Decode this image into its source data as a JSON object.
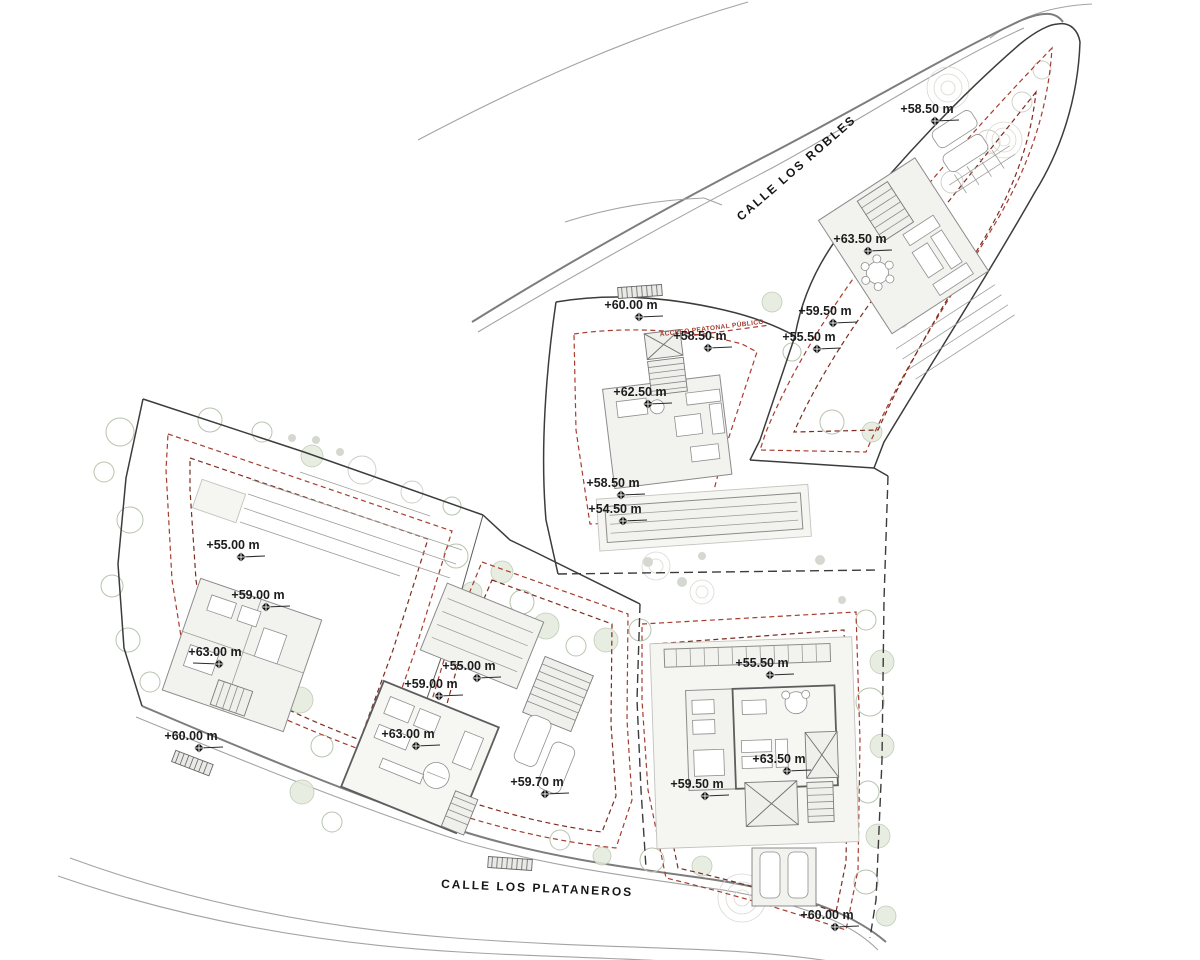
{
  "document": {
    "type": "architectural-site-plan"
  },
  "streets": [
    {
      "id": "robles",
      "name": "CALLE LOS ROBLES"
    },
    {
      "id": "plataneros",
      "name": "CALLE LOS PLATANEROS"
    }
  ],
  "annotations": {
    "public_path": "ACCESO PEATONAL PÚBLICO"
  },
  "elevation_markers": [
    {
      "label": "+58.50 m",
      "x": 935,
      "y": 121,
      "dir": "right"
    },
    {
      "label": "+63.50 m",
      "x": 868,
      "y": 251,
      "dir": "right"
    },
    {
      "label": "+59.50 m",
      "x": 833,
      "y": 323,
      "dir": "right"
    },
    {
      "label": "+55.50 m",
      "x": 817,
      "y": 349,
      "dir": "right"
    },
    {
      "label": "+60.00 m",
      "x": 639,
      "y": 317,
      "dir": "right"
    },
    {
      "label": "+58.50 m",
      "x": 708,
      "y": 348,
      "dir": "right"
    },
    {
      "label": "+62.50 m",
      "x": 648,
      "y": 404,
      "dir": "right"
    },
    {
      "label": "+58.50 m",
      "x": 621,
      "y": 495,
      "dir": "right"
    },
    {
      "label": "+54.50 m",
      "x": 623,
      "y": 521,
      "dir": "right"
    },
    {
      "label": "+55.00 m",
      "x": 241,
      "y": 557,
      "dir": "right"
    },
    {
      "label": "+59.00 m",
      "x": 266,
      "y": 607,
      "dir": "right"
    },
    {
      "label": "+63.00 m",
      "x": 219,
      "y": 664,
      "dir": "left"
    },
    {
      "label": "+60.00 m",
      "x": 199,
      "y": 748,
      "dir": "right"
    },
    {
      "label": "+55.00 m",
      "x": 477,
      "y": 678,
      "dir": "right"
    },
    {
      "label": "+59.00 m",
      "x": 439,
      "y": 696,
      "dir": "right"
    },
    {
      "label": "+63.00 m",
      "x": 416,
      "y": 746,
      "dir": "right"
    },
    {
      "label": "+59.70 m",
      "x": 545,
      "y": 794,
      "dir": "right"
    },
    {
      "label": "+55.50 m",
      "x": 770,
      "y": 675,
      "dir": "right"
    },
    {
      "label": "+63.50 m",
      "x": 787,
      "y": 771,
      "dir": "right"
    },
    {
      "label": "+59.50 m",
      "x": 705,
      "y": 796,
      "dir": "right"
    },
    {
      "label": "+60.00 m",
      "x": 835,
      "y": 927,
      "dir": "right"
    }
  ],
  "colors": {
    "boundary": "#3c3c3c",
    "setback": "#a73c2e",
    "setback_dark": "#7c2d21",
    "road": "#a3a3a3",
    "tree": "#b7c4ae",
    "building_fill": "#f2f2ef",
    "text": "#1c1c1c"
  }
}
